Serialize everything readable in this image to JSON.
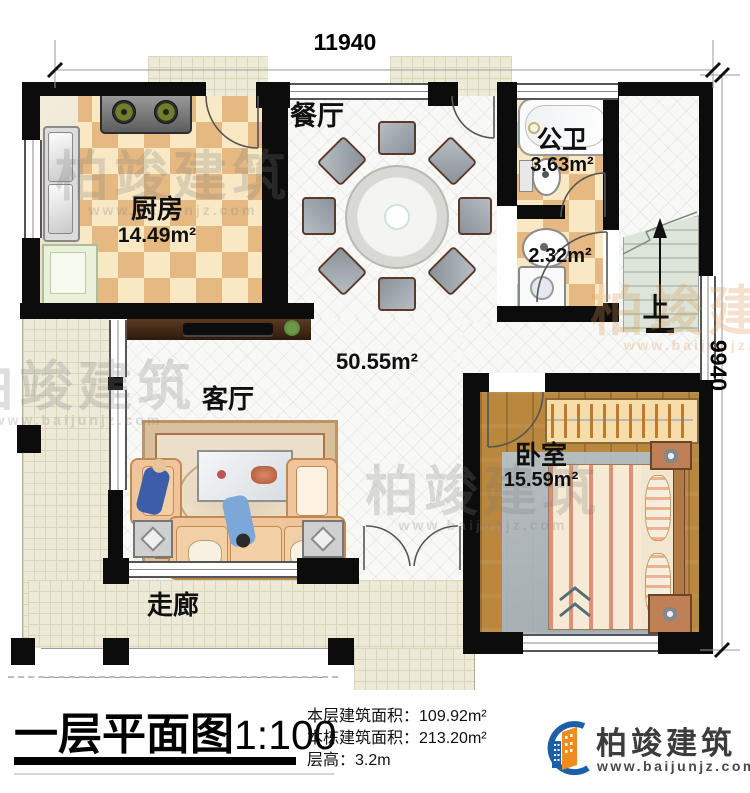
{
  "plan": {
    "dim_top": "11940",
    "dim_right": "9940",
    "rooms": {
      "kitchen": {
        "label": "厨房",
        "area": "14.49m²"
      },
      "dining": {
        "label": "餐厅"
      },
      "bath": {
        "label": "公卫",
        "area": "3.63m²"
      },
      "utility": {
        "area": "2.32m²"
      },
      "living": {
        "label": "客厅"
      },
      "open_area": "50.55m²",
      "bedroom": {
        "label": "卧室",
        "area": "15.59m²"
      },
      "corridor": {
        "label": "走廊"
      }
    },
    "stairs": {
      "label": "上"
    },
    "watermark": {
      "text": "柏竣建筑",
      "url": "www.baijunjz.com"
    }
  },
  "footer": {
    "title": "一层平面图",
    "scale": "1:100",
    "stats": [
      {
        "label": "本层建筑面积：",
        "value": "109.92m²"
      },
      {
        "label": "本栋建筑面积：",
        "value": "213.20m²"
      },
      {
        "label": "层高：",
        "value": "3.2m"
      }
    ],
    "logo": {
      "name": "柏竣建筑",
      "url": "www.baijunjz.com",
      "blue": "#1b5fa8",
      "orange": "#f08c1e"
    }
  }
}
